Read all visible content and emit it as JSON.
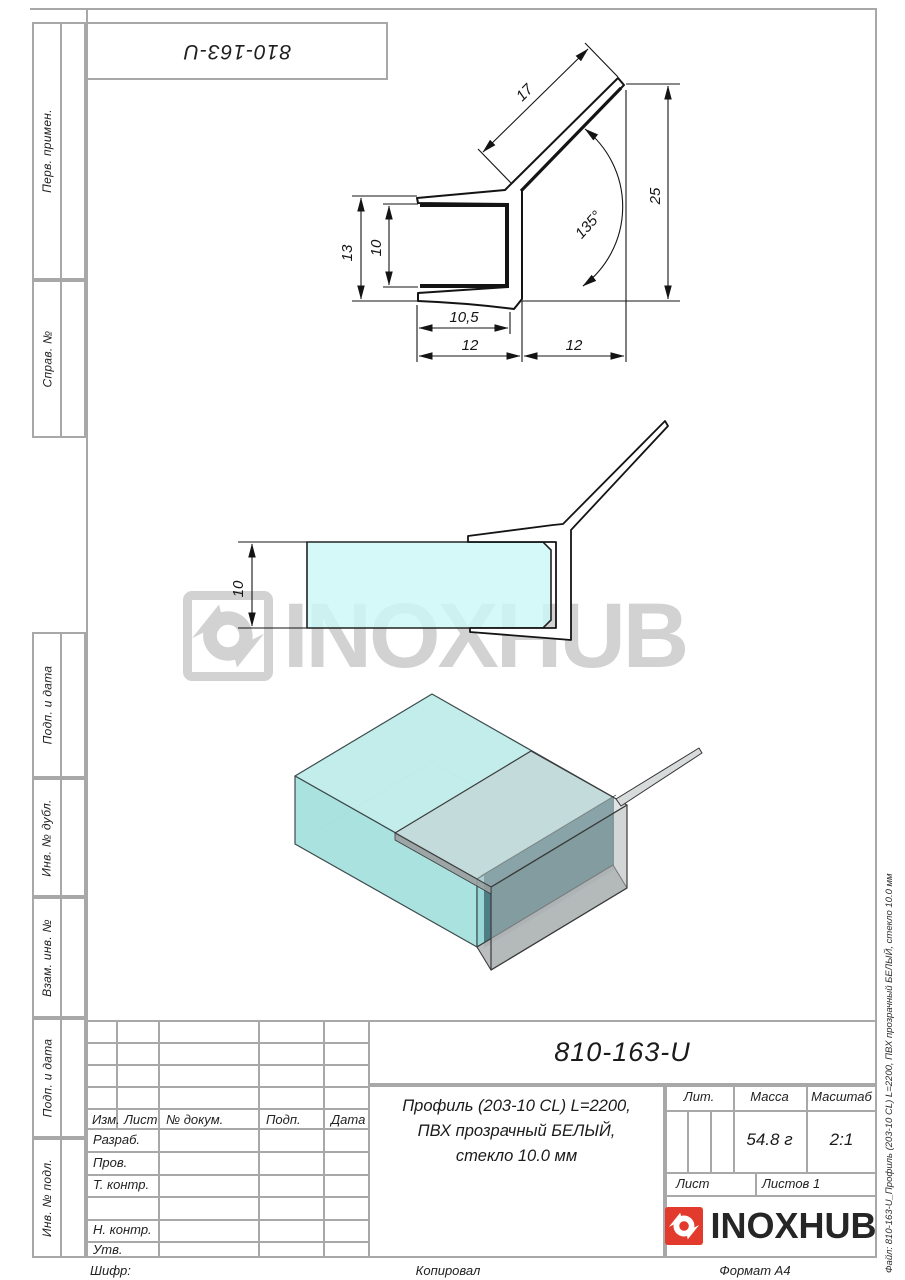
{
  "top_stamp": {
    "doc_number": "810-163-U"
  },
  "left_margin": {
    "items": [
      "Перв. примен.",
      "Справ. №",
      "Подп. и дата",
      "Инв. № дубл.",
      "Взам. инв. №",
      "Подп. и дата",
      "Инв. № подл."
    ]
  },
  "right_margin": {
    "file_note": "Файл: 810-163-U_Профиль (203-10 CL) L=2200, ПВХ прозрачный БЕЛЫЙ, стекло 10.0 мм"
  },
  "watermark": {
    "text": "INOXHUB"
  },
  "drawing": {
    "section_dims": {
      "arm_length": "17",
      "total_height": "25",
      "angle": "135°",
      "outer_height": "13",
      "glass_gap": "10",
      "inner_depth": "10,5",
      "channel_width": "12",
      "arm_span": "12"
    },
    "side_dims": {
      "glass_thickness": "10"
    }
  },
  "title_block": {
    "doc_number": "810-163-U",
    "description": [
      "Профиль (203-10 CL) L=2200,",
      "ПВХ прозрачный БЕЛЫЙ,",
      "стекло 10.0 мм"
    ],
    "col_headers": {
      "izm": "Изм.",
      "list": "Лист",
      "ndokum": "№ докум.",
      "podp": "Подп.",
      "data": "Дата"
    },
    "roles": {
      "r1": "Разраб.",
      "r2": "Пров.",
      "r3": "Т. контр.",
      "r4": "Н. контр.",
      "r5": "Утв."
    },
    "props": {
      "lit": "Лит.",
      "massa": "Масса",
      "masshtab": "Масштаб",
      "massa_value": "54.8 г",
      "scale_value": "2:1",
      "list": "Лист",
      "listov": "Листов 1"
    },
    "logo_text": "INOXHUB"
  },
  "footer": {
    "shifr": "Шифр:",
    "kopiroval": "Копировал",
    "format": "Формат A4"
  },
  "colors": {
    "glass": "#ccf8f8",
    "profile_gray": "#b9bcbd",
    "logo_red": "#e23b2d",
    "watermark": "#d2d2d2",
    "frame": "#a8a8a8",
    "line": "#141414"
  }
}
